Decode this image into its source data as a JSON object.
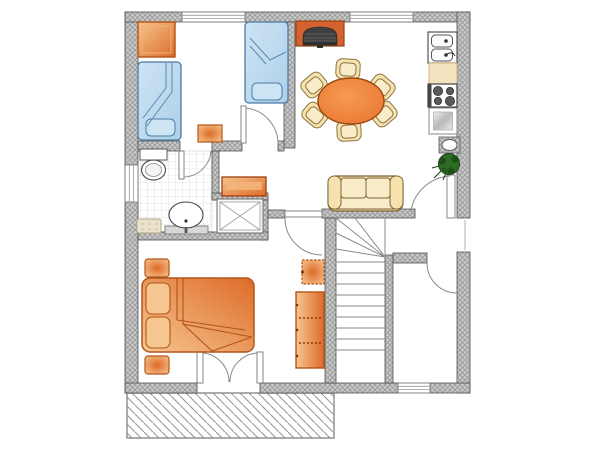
{
  "plan": {
    "type": "apartment-floor-plan",
    "colors": {
      "wall_fill": "#c9c9c9",
      "wall_hatch": "#9a9a9a",
      "wall_outline": "#4f4f4f",
      "floor": "#ffffff",
      "furniture_orange": "#e8853f",
      "furniture_orange_light": "#f6c690",
      "furniture_orange_deep": "#dd6b28",
      "furniture_orange_dark": "#b35418",
      "bed_blue": "#aed0e8",
      "bed_blue_light": "#cde4f4",
      "bed_blue_dark": "#4a7ba6",
      "seat_beige": "#f6e2ae",
      "seat_beige_light": "#faecc8",
      "seat_beige_dark": "#7a6434",
      "table_orange": "#e9762e",
      "table_orange_light": "#f59a55",
      "table_orange_dark": "#9a4a10",
      "plant_green": "#2e6b24",
      "plant_green_dark": "#174012",
      "fireplace_bg": "#d4622e",
      "fireplace_dark": "#3f3f3f",
      "fixture_white": "#ffffff",
      "fixture_stroke": "#555555",
      "counter_beige": "#f5e2c0",
      "basket_beige": "#eae2cc",
      "tile_line": "#dcdcdc",
      "terrace_line": "#999999",
      "door_line": "#8a8a8a"
    },
    "structure": {
      "windows": 4,
      "door_swings": 7,
      "stair_treads": 9,
      "terrace": "hatched, bottom-left"
    },
    "rooms": [
      {
        "name": "bedroom-upper",
        "furniture": [
          "wardrobe",
          "single-bed",
          "single-bed",
          "stool"
        ]
      },
      {
        "name": "bathroom",
        "furniture": [
          "toilet",
          "washbasin-vanity",
          "laundry-basket",
          "shower-stall"
        ]
      },
      {
        "name": "kitchen-dining",
        "furniture": [
          "fireplace",
          "round-dining-table",
          "chair",
          "chair",
          "chair",
          "chair",
          "chair",
          "chair",
          "double-sink",
          "counter",
          "stove-4-burner",
          "refrigerator",
          "boiler",
          "potted-plant"
        ]
      },
      {
        "name": "living-area",
        "furniture": [
          "sofa"
        ]
      },
      {
        "name": "hallway",
        "furniture": [
          "dresser"
        ]
      },
      {
        "name": "bedroom-lower",
        "furniture": [
          "double-bed",
          "nightstand",
          "nightstand",
          "stool",
          "shelf-unit"
        ]
      },
      {
        "name": "staircase",
        "furniture": []
      },
      {
        "name": "entry-room",
        "furniture": []
      },
      {
        "name": "terrace",
        "furniture": []
      }
    ]
  }
}
